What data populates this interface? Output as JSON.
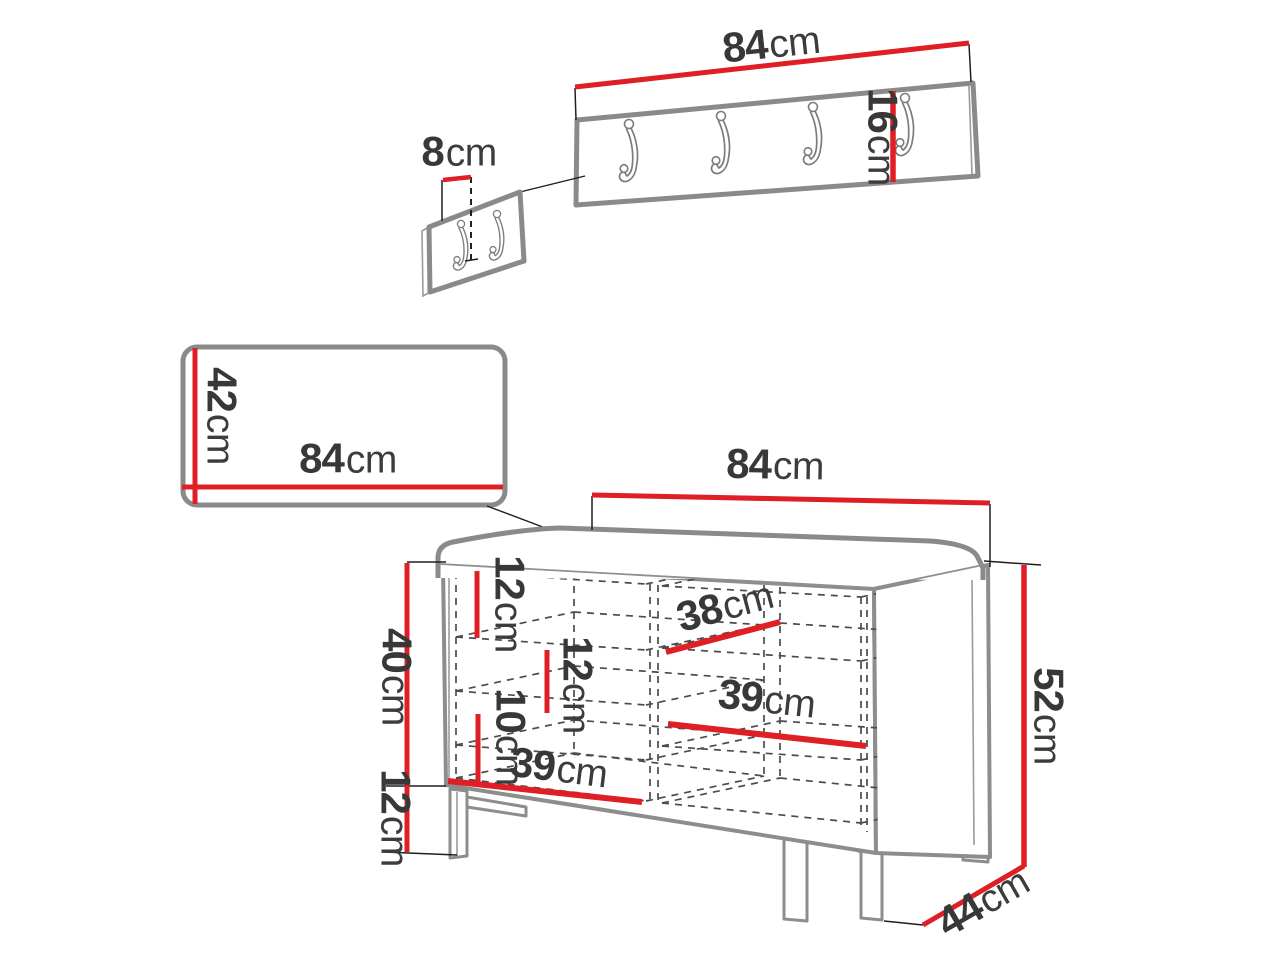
{
  "colors": {
    "dimension_red": "#de1f26",
    "outline_gray": "#8a8a8a",
    "hidden_line_gray": "#4c4c4c",
    "label_text": "#383838",
    "background": "#ffffff"
  },
  "items": {
    "wall_hanger_panel": {
      "hook_count": 4
    },
    "small_hook_panel": {
      "hook_count": 2
    },
    "upholstered_panel": {},
    "shoe_bench": {
      "compartments": 2
    }
  },
  "labels": {
    "rack_width": {
      "value": "84",
      "unit": "cm"
    },
    "rack_height": {
      "value": "16",
      "unit": "cm"
    },
    "hook_spacing": {
      "value": "8",
      "unit": "cm"
    },
    "panel_height": {
      "value": "42",
      "unit": "cm"
    },
    "panel_width": {
      "value": "84",
      "unit": "cm"
    },
    "bench_width": {
      "value": "84",
      "unit": "cm"
    },
    "bench_total_height": {
      "value": "52",
      "unit": "cm"
    },
    "bench_body_height": {
      "value": "40",
      "unit": "cm"
    },
    "bench_leg_height": {
      "value": "12",
      "unit": "cm"
    },
    "bench_depth": {
      "value": "44",
      "unit": "cm"
    },
    "gap_top": {
      "value": "12",
      "unit": "cm"
    },
    "gap_middle": {
      "value": "12",
      "unit": "cm"
    },
    "gap_bottom": {
      "value": "10",
      "unit": "cm"
    },
    "shelf_right_top": {
      "value": "38",
      "unit": "cm"
    },
    "shelf_right_bottom": {
      "value": "39",
      "unit": "cm"
    },
    "shelf_left_bottom": {
      "value": "39",
      "unit": "cm"
    }
  }
}
